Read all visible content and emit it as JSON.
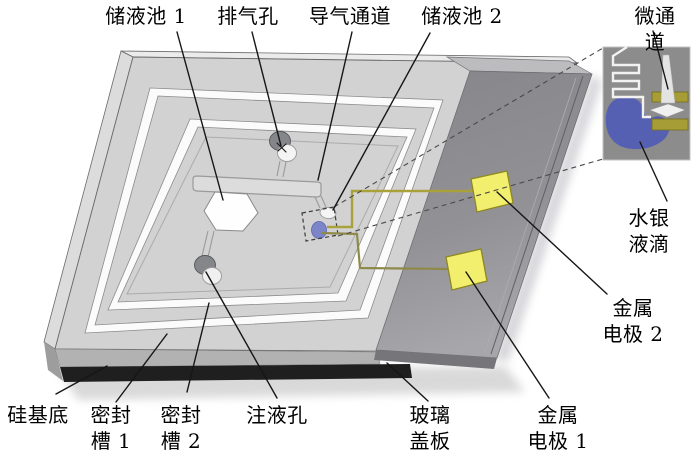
{
  "diagram": {
    "title": "微流控芯片结构示意图",
    "labels": {
      "reservoir1": "储液池 1",
      "vent_hole": "排气孔",
      "gas_channel": "导气通道",
      "reservoir2": "储液池 2",
      "microchannel": "微通道",
      "mercury_droplet": "水银液滴",
      "metal_electrode2": "金属\n电极 2",
      "metal_electrode1": "金属\n电极 1",
      "silicon_substrate": "硅基底",
      "seal_groove1": "密封\n槽 1",
      "seal_groove2": "密封\n槽 2",
      "injection_hole": "注液孔",
      "glass_cover": "玻璃\n盖板"
    },
    "colors": {
      "chip_gray": "#d2d2d2",
      "glass_gray": "#8a8a8f",
      "electrode_pad": "#f3ef6e",
      "wire_olive": "#a9a23c",
      "wire_olive2": "#8f8a4a",
      "mercury_blue": "#5560b2",
      "droplet_blue": "#7b85c7",
      "inset_bar_olive": "#a69d36",
      "inset_background": "#8c8c8c",
      "substrate_dark": "#1f1f1f"
    }
  }
}
